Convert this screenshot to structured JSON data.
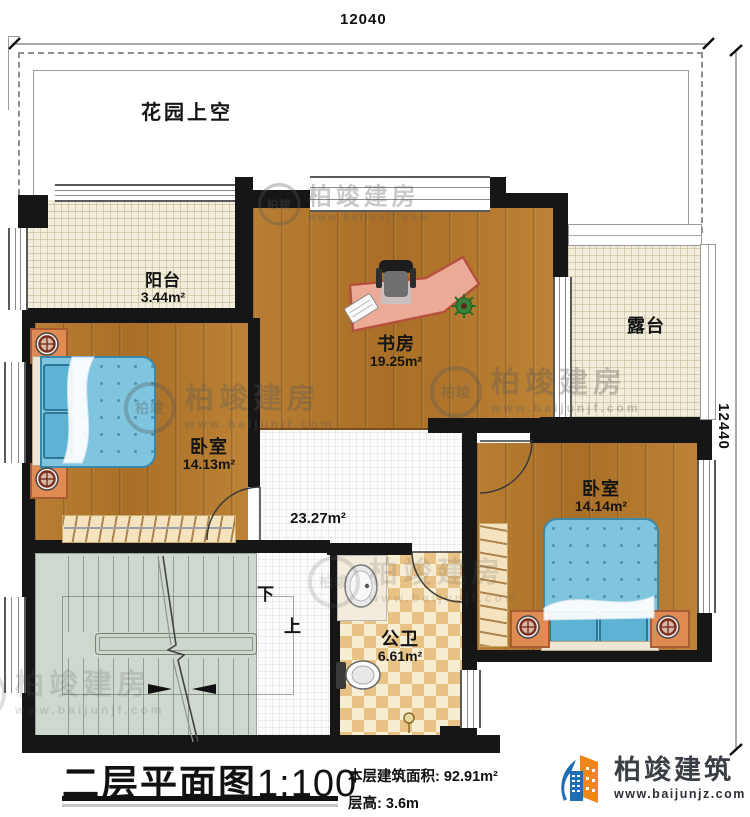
{
  "plan": {
    "garden_label": "花园上空",
    "dim_top": "12040",
    "dim_right": "12440",
    "stair_down": "下",
    "stair_up": "上",
    "rooms": [
      {
        "id": "balcony",
        "name": "阳台",
        "area": "3.44m²"
      },
      {
        "id": "study",
        "name": "书房",
        "area": "19.25m²"
      },
      {
        "id": "terrace",
        "name": "露台",
        "area": ""
      },
      {
        "id": "bedroom-left",
        "name": "卧室",
        "area": "14.13m²"
      },
      {
        "id": "hall",
        "name": "",
        "area": "23.27m²"
      },
      {
        "id": "bathroom",
        "name": "公卫",
        "area": "6.61m²"
      },
      {
        "id": "bedroom-right",
        "name": "卧室",
        "area": "14.14m²"
      }
    ]
  },
  "watermark": {
    "logo_text": "柏竣",
    "brand": "柏竣建房",
    "url": "www.baijunjf.com"
  },
  "titleblock": {
    "title": "二层平面图",
    "scale": "1:100",
    "area_label": "本层建筑面积:",
    "area_value": "92.91m²",
    "height_label": "层高:",
    "height_value": "3.6m"
  },
  "brand": {
    "name": "柏竣建筑",
    "url": "www.baijunjz.com"
  },
  "colors": {
    "wall": "#161616",
    "wood": "#b3782f",
    "cream_tile": "#f2edda",
    "checker_tan": "#e9c286",
    "bed_blue": "#7fc5de",
    "stairs_gray": "#ced8ce",
    "desk_salmon": "#ecab96",
    "brand_blue": "#1f6eb5",
    "brand_orange": "#f08519"
  }
}
